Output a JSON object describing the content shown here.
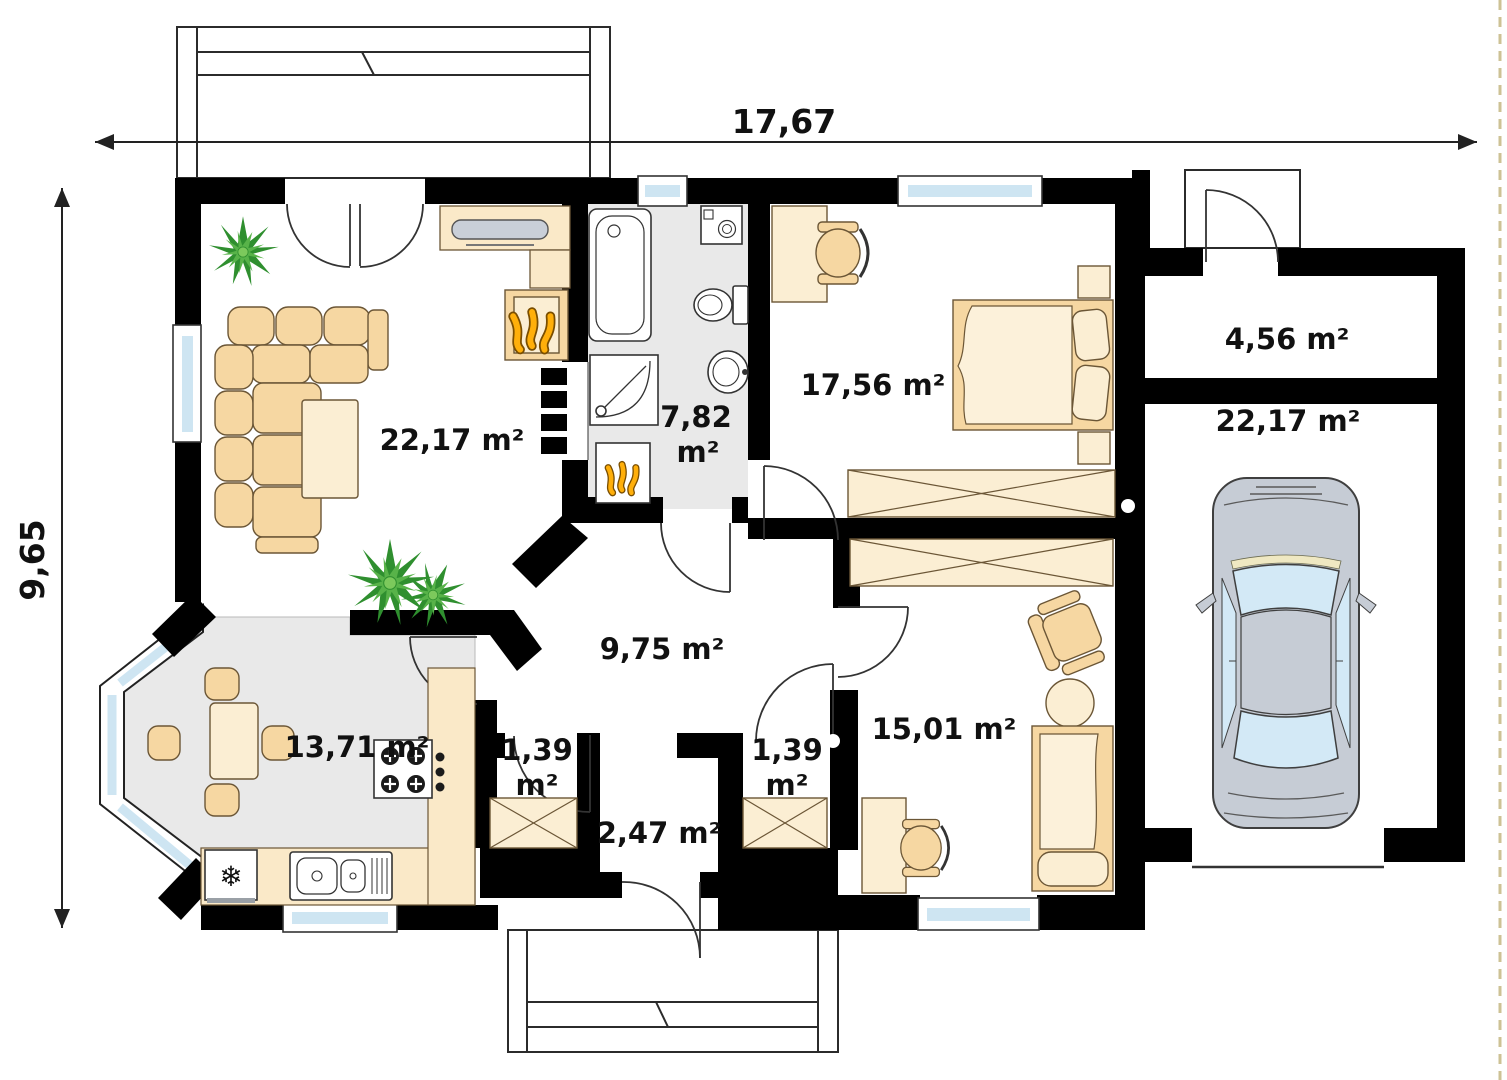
{
  "dimensions": {
    "width_label": "17,67",
    "height_label": "9,65"
  },
  "rooms": {
    "living": {
      "label": "22,17 m²"
    },
    "bathroom": {
      "area": "7,82",
      "unit": "m²"
    },
    "bedroom": {
      "label": "17,56 m²"
    },
    "hall": {
      "label": "9,75 m²"
    },
    "kitchen": {
      "label": "13,71 m²"
    },
    "closet_left": {
      "area": "1,39",
      "unit": "m²"
    },
    "closet_right": {
      "area": "1,39",
      "unit": "m²"
    },
    "vestibule": {
      "label": "2,47 m²"
    },
    "room2": {
      "label": "15,01 m²"
    },
    "entry": {
      "label": "4,56 m²"
    },
    "garage": {
      "label": "22,17 m²"
    }
  },
  "icons": {
    "fridge_snowflake": "❄"
  },
  "colors": {
    "wall": "#000000",
    "furniture": "#F6D7A2",
    "furniture_light": "#FBEED3",
    "floor_gray": "#E9E9E9",
    "window_blue": "#CEE5F2",
    "flame_orange": "#FFAF0A",
    "plant_green": "#2F8F2F",
    "car_gray": "#C6CCD5"
  }
}
